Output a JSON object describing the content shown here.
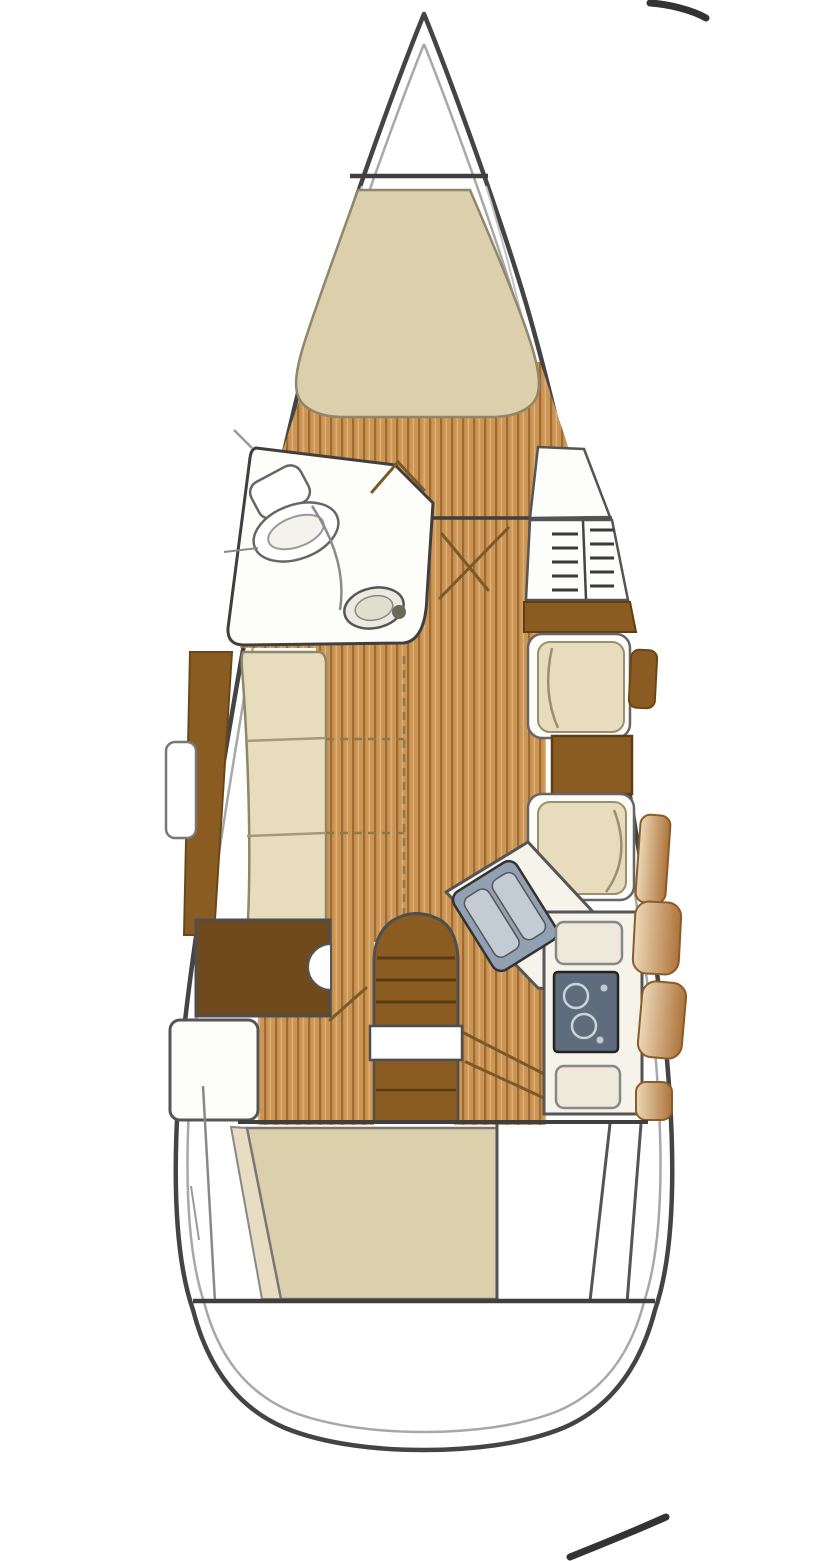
{
  "diagram": {
    "type": "floor-plan",
    "subject": "sailboat-interior-layout-top-view",
    "regions": [
      {
        "id": "anchor-locker",
        "label": "anchor locker"
      },
      {
        "id": "v-berth",
        "label": "v-berth"
      },
      {
        "id": "head",
        "label": "head with toilet and washbasin"
      },
      {
        "id": "hanging-locker",
        "label": "hanging locker"
      },
      {
        "id": "shelf-unit",
        "label": "shelf unit"
      },
      {
        "id": "port-settee",
        "label": "port settee"
      },
      {
        "id": "folding-table",
        "label": "folding saloon table (dashed outline)"
      },
      {
        "id": "starboard-dinette",
        "label": "starboard facing seats with table"
      },
      {
        "id": "galley",
        "label": "galley with twin sink and two-burner stove"
      },
      {
        "id": "companionway",
        "label": "companionway steps"
      },
      {
        "id": "port-cabinet",
        "label": "port aft cabinet"
      },
      {
        "id": "aft-berth",
        "label": "aft double berth"
      },
      {
        "id": "cockpit",
        "label": "stern deck / cockpit"
      }
    ],
    "colors": {
      "hull_line": "#444444",
      "liner": "#a8a8a8",
      "liner_light": "#c4c4c4",
      "deck": "#ffffff",
      "bulkhead": "#3f3f3f",
      "floor_base": "#cc9554",
      "floor_stripe": "#9e6b33",
      "floor_stripe_light": "#ddb078",
      "cushion": "#dccfab",
      "cushion_light": "#e7dcbc",
      "cushion_edge": "#8f866b",
      "cream_band": "#e8ddc2",
      "wood_mid": "#8a5c22",
      "wood_dark": "#70491c",
      "wood_grad_light": "#ecd9b9",
      "wood_grad_dark": "#af733b",
      "counter": "#f6f3ea",
      "lid": "#eee9da",
      "sink_gray": "#92a1b1",
      "sink_well": "#c3ccd4",
      "stove": "#5f6c7e",
      "burner_ring": "#ccd3da",
      "swing": "#7a5a2a",
      "artifact": "#333333"
    }
  }
}
